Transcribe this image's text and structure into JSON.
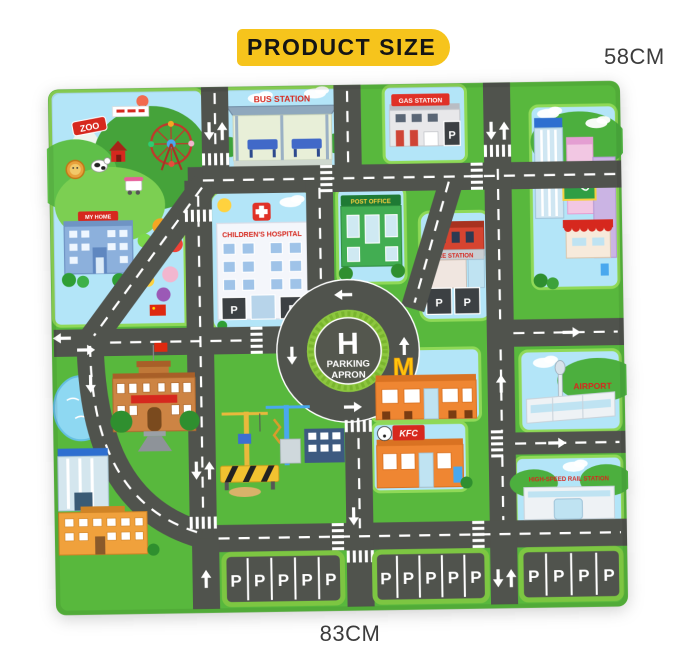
{
  "product": {
    "badge_label": "PRODUCT SIZE",
    "height_label": "58CM",
    "width_label": "83CM"
  },
  "mat": {
    "labels": {
      "zoo": "ZOO",
      "bus_station": "BUS STATION",
      "gas_station": "GAS STATION",
      "my_home": "MY HOME",
      "childrens_hospital": "CHILDREN'S HOSPITAL",
      "post_office": "POST OFFICE",
      "fire_station": "FIRE STATION",
      "helipad": "H",
      "parking_apron_line1": "PARKING",
      "parking_apron_line2": "APRON",
      "mcdonalds_arch": "M",
      "kfc": "KFC",
      "airport": "AIRPORT",
      "rail_station": "HIGH-SPEED RAIL STATION",
      "parking_letter": "P"
    },
    "colors": {
      "grass": "#58b83d",
      "road": "#50534d",
      "sky": "#b3e5f8",
      "marking": "#ffffff",
      "badge_yellow": "#f6c41c",
      "sign_red": "#d6281e",
      "curb_green": "#8fd957"
    }
  }
}
